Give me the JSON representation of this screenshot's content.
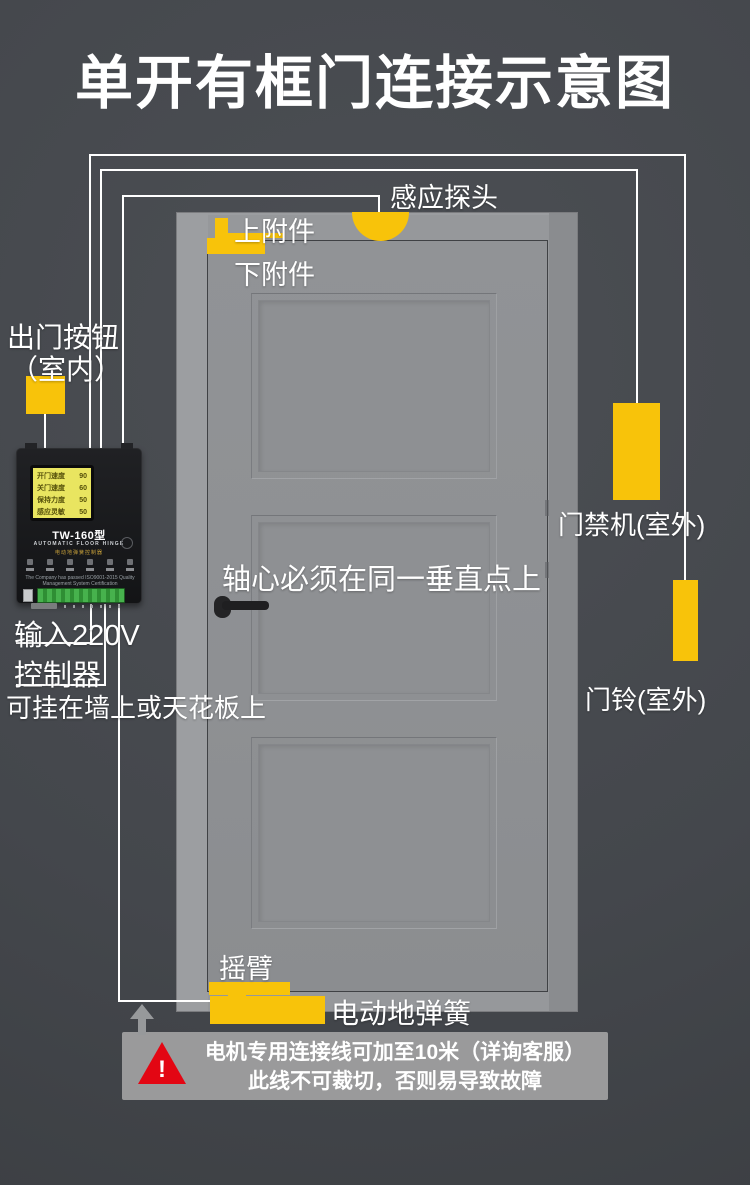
{
  "title": "单开有框门连接示意图",
  "door_labels": {
    "sensor_probe": "感应探头",
    "upper_attachment": "上附件",
    "lower_attachment": "下附件",
    "axis_note": "轴心必须在同一垂直点上",
    "rocker_arm": "摇臂",
    "floor_spring": "电动地弹簧"
  },
  "left_labels": {
    "exit_button_line1": "出门按钮",
    "exit_button_line2": "（室内）",
    "power_input": "输入220V",
    "controller": "控制器",
    "controller_mount_note": "可挂在墙上或天花板上"
  },
  "right_labels": {
    "access_control": "门禁机(室外)",
    "doorbell": "门铃(室外)"
  },
  "controller_device": {
    "model": "TW-160型",
    "subtitle": "AUTOMATIC FLOOR HINGE",
    "product_name": "电动地弹簧控制器",
    "lcd_lines": [
      {
        "name": "开门速度",
        "value": "90"
      },
      {
        "name": "关门速度",
        "value": "60"
      },
      {
        "name": "保持力度",
        "value": "50"
      },
      {
        "name": "感应灵敏",
        "value": "50"
      }
    ],
    "certification": "The Company has passed ISO9001-2015 Quality Management System Certification"
  },
  "warning": {
    "exclamation": "!",
    "line1": "电机专用连接线可加至10米（详询客服）",
    "line2": "此线不可裁切，否则易导致故障"
  },
  "colors": {
    "background": "#44474C",
    "accent_yellow": "#F8C30A",
    "door_gray": "#909295",
    "frame_gray": "#96989B",
    "wire_white": "#FFFFFF",
    "warning_red": "#E30613",
    "warning_box_gray": "#9E9E9E"
  }
}
